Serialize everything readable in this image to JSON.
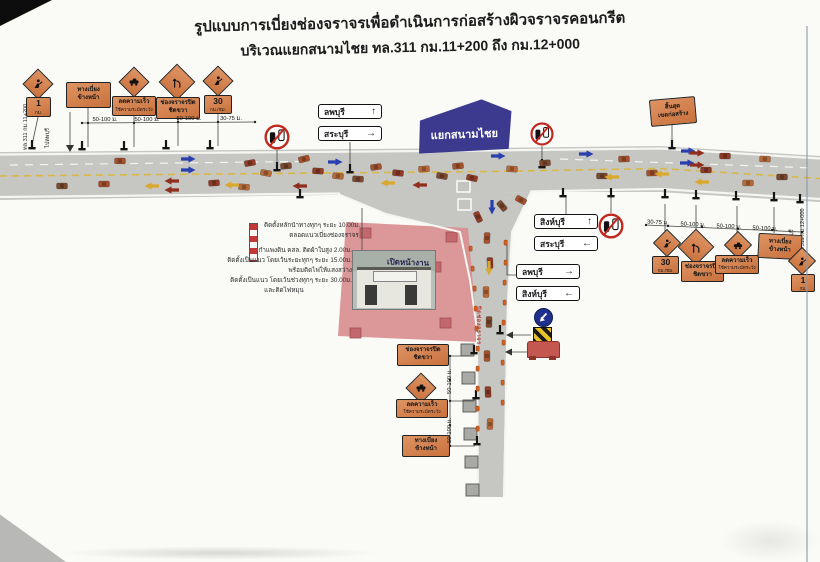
{
  "title": {
    "line1": "รูปแบบการเบี่ยงช่องจราจรเพื่อดำเนินการก่อสร้างผิวจราจรคอนกรีต",
    "line2": "บริเวณแยกสนามไชย ทล.311 กม.11+200 ถึง กม.12+000"
  },
  "junction": {
    "name": "แยกสนามไชย"
  },
  "km_markers": {
    "start_route": "ทล.311 กม.11+200",
    "start_dir": "ไปลพบุรี",
    "end_dir": "ไปสิงห์บุรี",
    "end_route": "ทล.311 กม.12+000"
  },
  "guide_signs": {
    "west": [
      {
        "dest": "ลพบุรี",
        "arrow": "↑"
      },
      {
        "dest": "สระบุรี",
        "arrow": "→"
      }
    ],
    "east_upper": [
      {
        "dest": "สิงห์บุรี",
        "arrow": "↑"
      },
      {
        "dest": "สระบุรี",
        "arrow": "←"
      }
    ],
    "east_lower": [
      {
        "dest": "ลพบุรี",
        "arrow": "→"
      },
      {
        "dest": "สิงห์บุรี",
        "arrow": "←"
      }
    ]
  },
  "work_signs": {
    "km1": {
      "l1": "1",
      "l2": "กม."
    },
    "detour": {
      "l1": "ทางเบี่ยง",
      "l2": "ข้างหน้า"
    },
    "slow": {
      "l1": "ลดความเร็ว",
      "l2": "ใช้ความระมัดระวัง"
    },
    "lane_closed": {
      "l1": "ช่องจราจรปิด",
      "l2": "ชิดขวา"
    },
    "speed30": {
      "l1": "30",
      "l2": "กม./ชม."
    },
    "end_zone": {
      "l1": "สิ้นสุด",
      "l2": "เขตก่อสร้าง"
    }
  },
  "distances": {
    "west": [
      "50-100 ม.",
      "50-100 ม.",
      "50-100 ม.",
      "30-75 ม."
    ],
    "east": [
      "30-75 ม.",
      "50-100 ม.",
      "50-100 ม.",
      "50-100 ม."
    ],
    "south": [
      "50-100 ม.",
      "50-100 ม."
    ]
  },
  "notes": {
    "guide_post_l1": "ติดตั้งหลักนำทางทุกๆ ระยะ 10.00ม.",
    "guide_post_l2": "ตลอดแนวเบี่ยงช่องจราจร",
    "wall": [
      "กำแพงดิน คสล. ติดผ้าใบสูง 2.00ม.",
      "ติดตั้งเป็นแนว โดยเว้นระยะทุกๆ ระยะ 15.00ม.",
      "พร้อมติดไฟให้แสงสว่าง",
      "ติดตั้งเป็นแนว โดยเว้นช่วงทุกๆ ระยะ 30.00ม.",
      "และติดไฟหมุน"
    ]
  },
  "zone": {
    "work_area": "เปิดหน้างาน",
    "closed_lane": "ปิดช่องจราจร"
  },
  "colors": {
    "road": "#c6c6c3",
    "sign_orange": "#d2814f",
    "work_pink": "#d98f90",
    "junction_blue": "#3b3a8e"
  }
}
